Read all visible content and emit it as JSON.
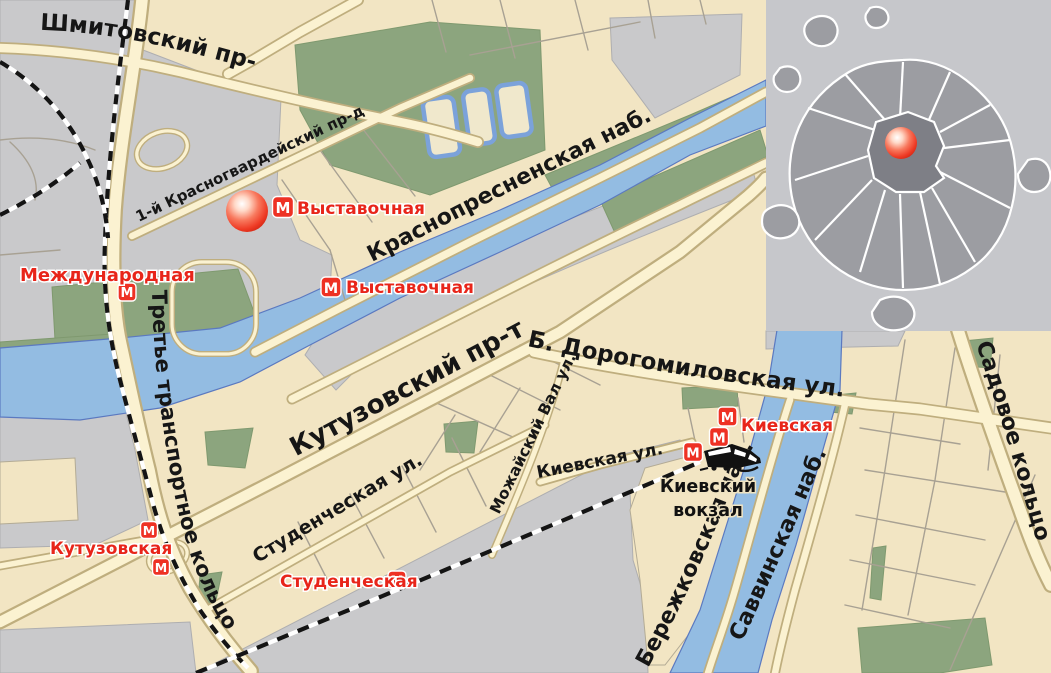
{
  "labels": {
    "streets": {
      "shmitovsky": "Шмитовский пр-д",
      "krasnogvardeysky": "1-й Красногвардейский пр-д",
      "krasnopresnenskaya_nab": "Краснопресненская наб.",
      "kutuzovsky": "Кутузовский пр-т",
      "dorogomilovskaya": "Б. Дорогомиловская ул.",
      "mozhaysky_val": "Можайский Вал ул.",
      "kievskaya_ul": "Киевская ул.",
      "studencheskaya_ul": "Студенческая ул.",
      "tretye_koltso": "Третье транспортное кольцо",
      "berezhkovskaya_nab": "Бережковская наб.",
      "savvinskaya_nab": "Саввинская наб.",
      "sadovoe_koltso": "Садовое кольцо"
    },
    "stations": {
      "vystavochnaya": "Выставочная",
      "mezhdunarodnaya": "Международная",
      "kievskaya": "Киевская",
      "kutuzovskaya": "Кутузовская",
      "studencheskaya": "Студенческая"
    },
    "landmarks": {
      "kievsky_vokzal_line1": "Киевский",
      "kievsky_vokzal_line2": "вокзал"
    },
    "metro_m": "М"
  },
  "colors": {
    "land": "#f2e5c3",
    "industrial": "#c9c9cb",
    "park": "#8ca57e",
    "water": "#93bce2",
    "road_fill": "#fbf2d1",
    "road_casing": "#bfae7e",
    "metro_red": "#ee3124",
    "station_label_red": "#e8251a",
    "marker_red": "#ee3a24",
    "inset_bg": "#c6c7cb",
    "inset_city": "#9c9da2",
    "inset_center": "#7e7f86"
  }
}
